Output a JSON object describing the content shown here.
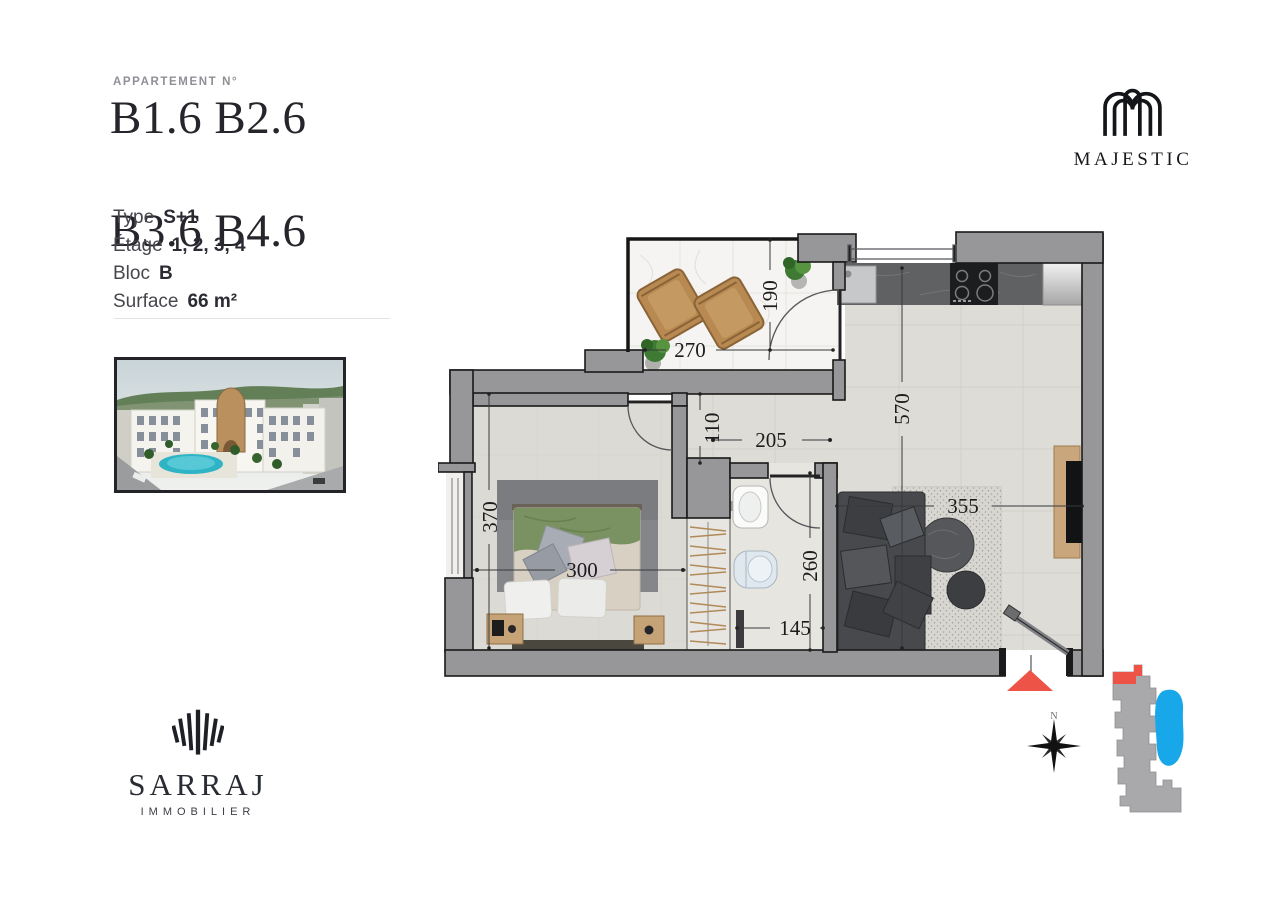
{
  "header": {
    "label": "APPARTEMENT N°",
    "line1": "B1.6 B2.6",
    "line2": "B3.6 B4.6"
  },
  "specs": {
    "rows": [
      {
        "label": "Type",
        "value": "S+1"
      },
      {
        "label": "Étage",
        "value": "1, 2, 3, 4"
      },
      {
        "label": "Bloc",
        "value": "B"
      },
      {
        "label": "Surface",
        "value": "66 m²"
      }
    ]
  },
  "brand": {
    "majestic": "MAJESTIC",
    "sarraj": "SARRAJ",
    "sarraj_sub": "IMMOBILIER"
  },
  "plan": {
    "dims": {
      "terrace_width": "270",
      "terrace_depth": "190",
      "hall_width": "110",
      "hall_length": "205",
      "living_depth": "570",
      "bedroom_depth": "370",
      "bedroom_width": "300",
      "bath_depth": "260",
      "bath_width": "145",
      "living_width": "355"
    },
    "compass_north": "N",
    "colors": {
      "accent_red": "#ee5347",
      "pool_blue": "#18a7e8",
      "wall_gray": "#97979a",
      "floor": "#dedcd7",
      "terrace_floor": "#f5f4f2"
    }
  }
}
